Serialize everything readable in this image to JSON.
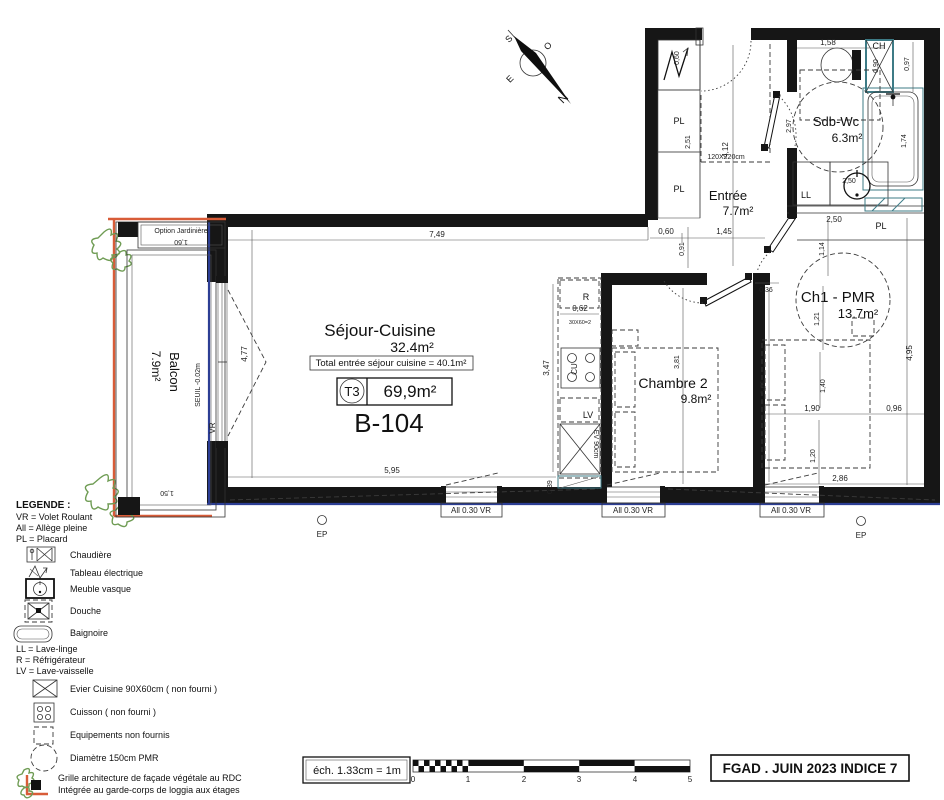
{
  "compass": {
    "n": "N",
    "s": "S",
    "e": "E",
    "o": "O"
  },
  "unit": {
    "code": "B-104",
    "type": "T3",
    "total_area": "69,9m²",
    "note": "Total entrée séjour cuisine = 40.1m²"
  },
  "rooms": {
    "sejour": {
      "name": "Séjour-Cuisine",
      "area": "32.4m²"
    },
    "entree": {
      "name": "Entrée",
      "area": "7.7m²"
    },
    "sdb": {
      "name": "Sdb-Wc",
      "area": "6.3m²"
    },
    "ch1": {
      "name": "Ch1 - PMR",
      "area": "13.7m²"
    },
    "ch2": {
      "name": "Chambre 2",
      "area": "9.8m²"
    },
    "balcon": {
      "name": "Balcon",
      "area": "7.9m²",
      "seuil": "SEUIL -0.02m",
      "option": "Option Jardinière",
      "vr": "VR"
    }
  },
  "fixtures": {
    "ch": "CH",
    "ll": "LL",
    "pl": "PL",
    "r": "R",
    "cu": "CU",
    "lv": "LV",
    "ev": "EV 90cm",
    "hob_note": "30X60=2",
    "door_size": "120X220cm",
    "window_label": "All 0.30 VR",
    "ep": "EP"
  },
  "dims": {
    "d036": "0,36",
    "d039": "0,39",
    "d060": "0,60",
    "d062": "0,62",
    "d090": "0,90",
    "d091": "0,91",
    "d096": "0,96",
    "d097": "0,97",
    "d114": "1,14",
    "d120": "1,20",
    "d121": "1,21",
    "d140": "1,40",
    "d145": "1,45",
    "d150": "1,50",
    "d158": "1,58",
    "d160": "1,60",
    "d174": "1,74",
    "d190": "1,90",
    "d250": "2,50",
    "d251": "2,51",
    "d286": "2,86",
    "d297": "2,97",
    "d347": "3,47",
    "d381": "3,81",
    "d412": "4,12",
    "d477": "4,77",
    "d495": "4,95",
    "d595": "5,95",
    "d749": "7,49"
  },
  "legend": {
    "title": "LEGENDE :",
    "abbr1": "VR = Volet Roulant",
    "abbr2": "All = Allège pleine",
    "abbr3": "PL = Placard",
    "items": [
      {
        "label": "Chaudière"
      },
      {
        "label": "Tableau électrique"
      },
      {
        "label": "Meuble vasque"
      },
      {
        "label": "Douche"
      },
      {
        "label": "Baignoire"
      }
    ],
    "abbr4": "LL = Lave-linge",
    "abbr5": "R = Réfrigérateur",
    "abbr6": "LV = Lave-vaisselle",
    "items2": [
      {
        "label": "Evier Cuisine 90X60cm ( non fourni )"
      },
      {
        "label": "Cuisson ( non fourni )"
      },
      {
        "label": "Equipements non fournis"
      },
      {
        "label": "Diamètre 150cm PMR"
      }
    ],
    "grille_line1": "Grille architecture de façade végétale au RDC",
    "grille_line2": "Intégrée au garde-corps de loggia aux étages"
  },
  "footer": {
    "scale_label": "éch. 1.33cm = 1m",
    "ticks": [
      "0",
      "1",
      "2",
      "3",
      "4",
      "5"
    ],
    "doc_ref": "FGAD . JUIN 2023 INDICE 7"
  }
}
